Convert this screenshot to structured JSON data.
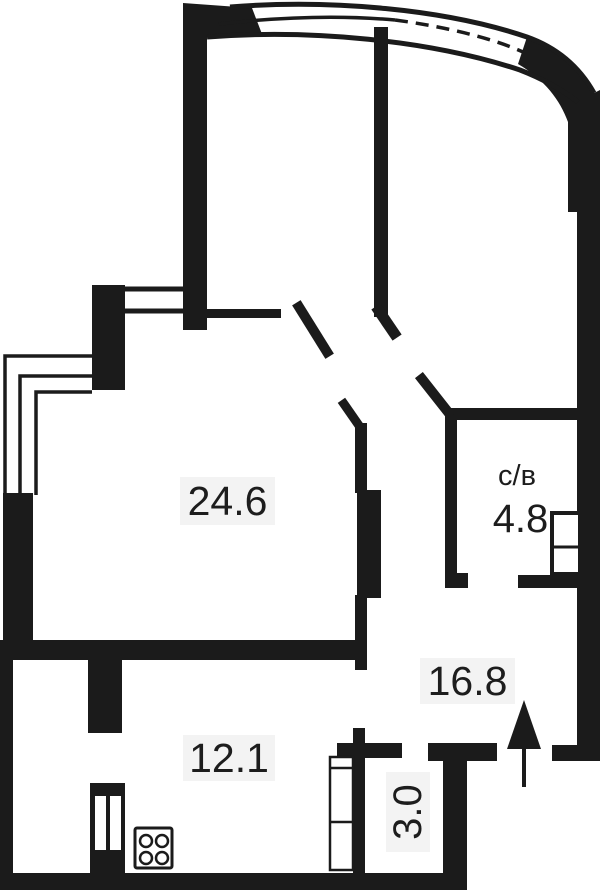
{
  "title": "apartment-floor-plan",
  "rooms": {
    "living": {
      "area_label": "24.6"
    },
    "kitchen": {
      "area_label": "12.1"
    },
    "hallway": {
      "area_label": "16.8"
    },
    "bathroom": {
      "name_label": "с/в",
      "area_label": "4.8"
    },
    "storage": {
      "area_label": "3.0"
    }
  },
  "icons": {
    "stove": "stove-icon",
    "entry_arrow": "entry-arrow-icon",
    "wardrobe": "wardrobe-icon",
    "duct_shaft": "duct-shaft-icon",
    "bay_window": "bay-window-icon",
    "corner_window": "corner-window-icon"
  },
  "colors": {
    "wall": "#1b1b1b",
    "background": "#ffffff",
    "label_bg": "#f3f3f3",
    "text": "#1d1d1d"
  }
}
